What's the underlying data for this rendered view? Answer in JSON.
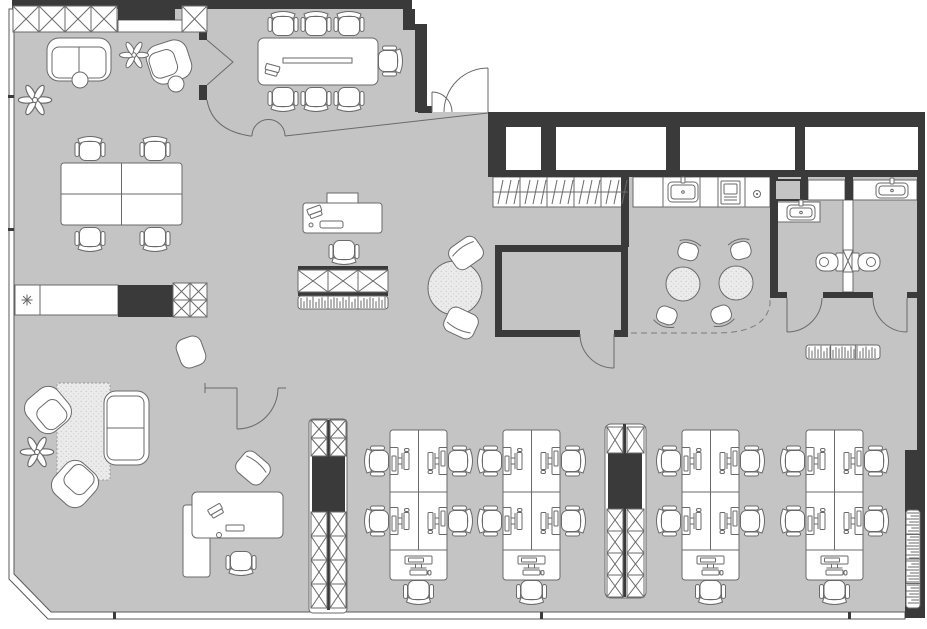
{
  "meta": {
    "label": "office-floor-plan",
    "canvas": {
      "w": 927,
      "h": 629
    }
  },
  "colors": {
    "floor": "#c4c4c4",
    "wall": "#3a3a3a",
    "line": "#6a6a6a",
    "furniture": "#ffffff",
    "outside": "#ffffff"
  },
  "floor": {
    "points": "9,9 412,9 412,30 424,30 424,112 925,112 925,618 48,618 9,578",
    "shell": "M9,9 L9,579 L48,619 L905,619 L905,612 L51,612 L14,574 L14,9 Z"
  },
  "dark_walls": [
    [
      12,
      0,
      400,
      9
    ],
    [
      403,
      9,
      12,
      21
    ],
    [
      415,
      24,
      12,
      88
    ],
    [
      199,
      9,
      8,
      31
    ],
    [
      199,
      85,
      8,
      15
    ],
    [
      488,
      112,
      437,
      65
    ],
    [
      917,
      177,
      8,
      275
    ],
    [
      905,
      450,
      20,
      168
    ],
    [
      495,
      245,
      133,
      7
    ],
    [
      495,
      245,
      7,
      92
    ],
    [
      621,
      245,
      7,
      92
    ],
    [
      495,
      330,
      85,
      7
    ],
    [
      614,
      330,
      14,
      7
    ],
    [
      621,
      177,
      8,
      70
    ],
    [
      770,
      177,
      8,
      121
    ],
    [
      770,
      292,
      17,
      6
    ],
    [
      823,
      292,
      50,
      6
    ],
    [
      907,
      292,
      18,
      6
    ],
    [
      801,
      177,
      7,
      23
    ],
    [
      845,
      177,
      8,
      23
    ],
    [
      118,
      285,
      55,
      32
    ],
    [
      312,
      456,
      33,
      56
    ],
    [
      327,
      420,
      3,
      190
    ],
    [
      608,
      453,
      34,
      56
    ],
    [
      623,
      424,
      3,
      173
    ],
    [
      118,
      8,
      57,
      12
    ],
    [
      298,
      266,
      90,
      4
    ],
    [
      298,
      292,
      90,
      4
    ],
    [
      418,
      106,
      14,
      7
    ],
    [
      113,
      612,
      3,
      7
    ],
    [
      540,
      612,
      3,
      7
    ],
    [
      848,
      612,
      3,
      7
    ],
    [
      8,
      228,
      6,
      3
    ],
    [
      8,
      95,
      6,
      3
    ]
  ],
  "windows": [
    [
      506,
      127,
      35,
      43
    ],
    [
      556,
      127,
      110,
      43
    ],
    [
      680,
      127,
      115,
      43
    ],
    [
      805,
      127,
      113,
      43
    ]
  ],
  "white_rects": [
    {
      "r": [
        493,
        177,
        135,
        30
      ],
      "n": "wardrobe-hatched"
    },
    {
      "r": [
        633,
        177,
        137,
        30
      ],
      "n": "kitchen-counter"
    },
    {
      "r": [
        808,
        180,
        37,
        20
      ],
      "n": "bath-cabinet"
    },
    {
      "r": [
        775,
        202,
        45,
        20
      ],
      "n": "bath-sink-counter-left"
    },
    {
      "r": [
        853,
        180,
        64,
        20
      ],
      "n": "bath-sink-counter-right"
    },
    {
      "r": [
        843,
        200,
        10,
        92
      ],
      "n": "bath-divider-wall"
    },
    {
      "r": [
        118,
        20,
        64,
        12
      ],
      "n": "top-counter"
    },
    {
      "r": [
        15,
        285,
        25,
        30
      ],
      "n": "kitchenette-unit"
    },
    {
      "r": [
        40,
        285,
        78,
        30
      ],
      "n": "kitchenette-counter"
    },
    {
      "r": [
        303,
        203,
        79,
        30
      ],
      "rx": 3,
      "n": "reception-desk"
    },
    {
      "r": [
        327,
        193,
        31,
        10
      ],
      "n": "reception-shelf"
    },
    {
      "r": [
        183,
        505,
        27,
        72
      ],
      "rx": 3,
      "n": "credenza"
    },
    {
      "r": [
        192,
        492,
        91,
        46
      ],
      "rx": 5,
      "n": "executive-desk"
    },
    {
      "r": [
        258,
        38,
        120,
        47
      ],
      "rx": 6,
      "n": "conference-table"
    },
    {
      "r": [
        283,
        58,
        69,
        5
      ],
      "n": "table-groove"
    },
    {
      "r": [
        309,
        419,
        38,
        194
      ],
      "rx": 4,
      "n": "storage-column"
    },
    {
      "r": [
        605,
        424,
        41,
        174
      ],
      "rx": 6,
      "n": "storage-column"
    }
  ],
  "x_cells": [
    [
      13,
      6,
      26,
      26
    ],
    [
      39,
      6,
      26,
      26
    ],
    [
      65,
      6,
      26,
      26
    ],
    [
      91,
      6,
      26,
      26
    ],
    [
      182,
      6,
      25,
      26
    ],
    [
      173,
      283,
      17,
      17
    ],
    [
      190,
      283,
      17,
      17
    ],
    [
      173,
      300,
      17,
      17
    ],
    [
      190,
      300,
      17,
      17
    ],
    [
      298,
      270,
      30,
      22
    ],
    [
      328,
      270,
      30,
      22
    ],
    [
      358,
      270,
      30,
      22
    ],
    [
      311,
      420,
      16,
      18
    ],
    [
      330,
      420,
      16,
      18
    ],
    [
      311,
      438,
      16,
      18
    ],
    [
      330,
      438,
      16,
      18
    ],
    [
      311,
      512,
      16,
      24
    ],
    [
      330,
      512,
      16,
      24
    ],
    [
      311,
      536,
      16,
      24
    ],
    [
      330,
      536,
      16,
      24
    ],
    [
      311,
      560,
      16,
      24
    ],
    [
      330,
      560,
      16,
      24
    ],
    [
      311,
      584,
      16,
      24
    ],
    [
      330,
      584,
      16,
      24
    ],
    [
      607,
      427,
      16,
      26
    ],
    [
      627,
      427,
      17,
      26
    ],
    [
      607,
      509,
      16,
      22
    ],
    [
      627,
      509,
      17,
      22
    ],
    [
      607,
      531,
      16,
      22
    ],
    [
      627,
      531,
      17,
      22
    ],
    [
      607,
      553,
      16,
      22
    ],
    [
      627,
      553,
      17,
      22
    ],
    [
      607,
      575,
      16,
      22
    ],
    [
      627,
      575,
      17,
      22
    ],
    [
      843,
      250,
      10,
      22
    ]
  ],
  "wardrobe": {
    "x": 493,
    "y": 177,
    "w": 135,
    "h": 30,
    "cells": 5
  },
  "kitchen_dividers": [
    663,
    700,
    718,
    745
  ],
  "shelves": [
    {
      "x": 298,
      "y": 296,
      "w": 90,
      "h": 13,
      "dir": "h",
      "sections": 3
    },
    {
      "x": 806,
      "y": 345,
      "w": 74,
      "h": 14,
      "dir": "h",
      "sections": 3
    },
    {
      "x": 906,
      "y": 510,
      "w": 14,
      "h": 98,
      "dir": "v",
      "sections": 4
    }
  ],
  "paths": [
    {
      "d": "M207,100 Q212,130 250,136 L252,136",
      "c": "ln",
      "n": "conference-partition"
    },
    {
      "d": "M285,136 L488,113",
      "c": "ln",
      "n": "conference-partition"
    },
    {
      "d": "M252,136 A16.5,16.5 0 0 1 285,136",
      "c": "ln",
      "n": "door-swing"
    },
    {
      "d": "M207,40 L233,62 L207,85",
      "c": "ln",
      "n": "conference-door-leaf"
    },
    {
      "d": "M488,68 A44,44 0 0 0 444,112 M488,68 L488,112",
      "c": "ln",
      "n": "entry-door-swing"
    },
    {
      "d": "M432,92 A20,20 0 0 1 452,112 M432,92 L432,112",
      "c": "ln",
      "n": "entry-door-swing"
    },
    {
      "d": "M580,334 A34,34 0 0 0 614,368 M614,334 L614,368",
      "c": "ln",
      "n": "room-door-swing"
    },
    {
      "d": "M822,298 A35,35 0 0 1 787,332 M787,298 L787,332",
      "c": "ln",
      "n": "bathroom-door-swing"
    },
    {
      "d": "M873,298 A34,34 0 0 0 907,332 M907,298 L907,332",
      "c": "ln",
      "n": "bathroom-door-swing"
    },
    {
      "d": "M205,383 L205,393 M205,388 L237,388 M278,388 L286,388 M278,388 A41,41 0 0 1 237,429 M237,388 L237,429",
      "c": "ln",
      "n": "lounge-door-swing"
    },
    {
      "d": "M631,333 L716,333 Q766,333 770,304 L770,298",
      "c": "lnD",
      "n": "cafe-zone-boundary"
    },
    {
      "d": "M493,192 L628,192",
      "c": "ln",
      "n": "wardrobe-midline"
    }
  ],
  "cluster": {
    "x": 61,
    "y": 163,
    "w": 121,
    "h": 62
  },
  "banks": [
    [
      390,
      430
    ],
    [
      503,
      430
    ],
    [
      682,
      430
    ],
    [
      806,
      430
    ]
  ],
  "workstations": [
    [
      91,
      177,
      0
    ],
    [
      152,
      177,
      0
    ],
    [
      91,
      211,
      180
    ],
    [
      152,
      211,
      180
    ]
  ],
  "chairs": {
    "office": [
      [
        90,
        151,
        0
      ],
      [
        155,
        151,
        0
      ],
      [
        90,
        237,
        180
      ],
      [
        155,
        237,
        180
      ],
      [
        344,
        250,
        180
      ],
      [
        241,
        561,
        180
      ],
      [
        283,
        26,
        0
      ],
      [
        316,
        26,
        0
      ],
      [
        349,
        26,
        0
      ],
      [
        283,
        97,
        180
      ],
      [
        316,
        97,
        180
      ],
      [
        349,
        97,
        180
      ],
      [
        388,
        61,
        90
      ]
    ],
    "cube": [
      [
        466,
        253,
        -35
      ],
      [
        461,
        323,
        205
      ],
      [
        253,
        468,
        40
      ]
    ],
    "cafe": [
      [
        688,
        252,
        15
      ],
      [
        667,
        315,
        200
      ],
      [
        741,
        251,
        -15
      ],
      [
        721,
        314,
        160
      ]
    ],
    "pouf": [
      [
        191,
        352,
        -20
      ]
    ]
  },
  "furnishings": [
    {
      "t": "rug",
      "x": 57,
      "y": 383,
      "w": 53,
      "h": 97
    },
    {
      "t": "round-table",
      "cx": 455,
      "cy": 288,
      "r": 27
    },
    {
      "t": "cafe-table",
      "cx": 683,
      "cy": 284,
      "r": 17
    },
    {
      "t": "cafe-table",
      "cx": 736,
      "cy": 283,
      "r": 17
    },
    {
      "t": "sofa-h",
      "x": 47,
      "y": 38,
      "w": 64,
      "h": 43
    },
    {
      "t": "sofa-v",
      "x": 104,
      "y": 391,
      "w": 45,
      "h": 74
    },
    {
      "t": "armchair",
      "cx": 169,
      "cy": 62,
      "rot": 72
    },
    {
      "t": "armchair",
      "cx": 48,
      "cy": 410,
      "rot": -40
    },
    {
      "t": "armchair",
      "cx": 75,
      "cy": 484,
      "rot": 222
    },
    {
      "t": "plant",
      "cx": 134,
      "cy": 55,
      "s": 1.0
    },
    {
      "t": "plant",
      "cx": 35,
      "cy": 100,
      "s": 1.15
    },
    {
      "t": "plant",
      "cx": 37,
      "cy": 452,
      "s": 1.15
    },
    {
      "t": "circle-table",
      "cx": 80,
      "cy": 80,
      "r": 8
    },
    {
      "t": "circle-table",
      "cx": 176,
      "cy": 84,
      "r": 8
    },
    {
      "t": "shaft",
      "x": 775,
      "y": 180,
      "w": 26,
      "h": 20
    },
    {
      "t": "toilet",
      "cx": 829,
      "cy": 262,
      "dir": "left"
    },
    {
      "t": "toilet",
      "cx": 866,
      "cy": 262,
      "dir": "right"
    },
    {
      "t": "sink",
      "x": 787,
      "y": 205,
      "w": 28,
      "h": 15
    },
    {
      "t": "sink",
      "x": 876,
      "y": 183,
      "w": 32,
      "h": 15
    },
    {
      "t": "sink",
      "x": 668,
      "y": 182,
      "w": 30,
      "h": 20
    },
    {
      "t": "appliance",
      "x": 721,
      "y": 181,
      "w": 19,
      "h": 23
    },
    {
      "t": "burner",
      "cx": 757,
      "cy": 194
    },
    {
      "t": "asterisk",
      "cx": 27,
      "cy": 300
    },
    {
      "t": "laptop",
      "cx": 315,
      "cy": 212,
      "rot": -20
    },
    {
      "t": "laptop",
      "cx": 272,
      "cy": 70,
      "rot": 15
    },
    {
      "t": "laptop",
      "cx": 216,
      "cy": 511,
      "rot": -30
    },
    {
      "t": "phone",
      "x": 320,
      "y": 221,
      "w": 23,
      "h": 7
    },
    {
      "t": "tray",
      "x": 226,
      "y": 525,
      "w": 18,
      "h": 6
    },
    {
      "t": "dot",
      "cx": 219,
      "cy": 535,
      "r": 2.5
    },
    {
      "t": "dot",
      "cx": 311,
      "cy": 225,
      "r": 2
    }
  ]
}
